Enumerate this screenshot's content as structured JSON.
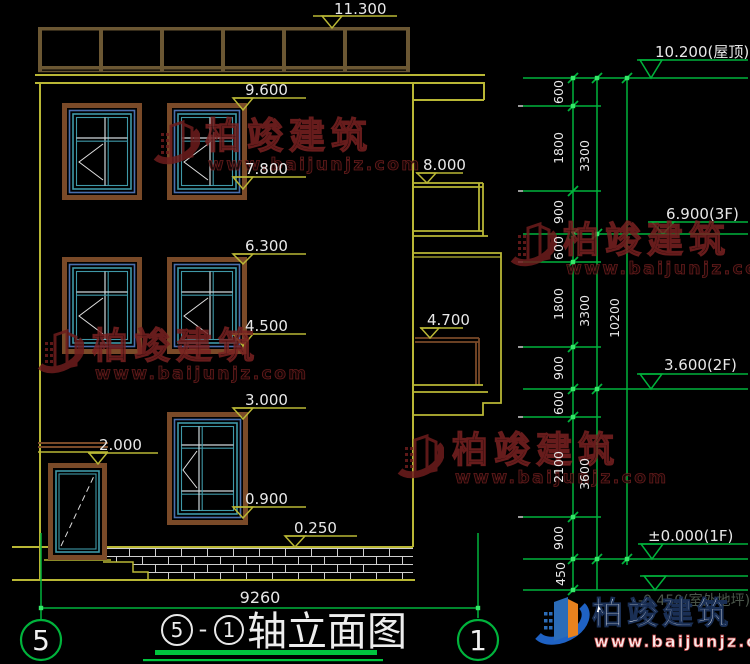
{
  "marks_left": [
    "11.300",
    "9.600",
    "7.800",
    "8.000",
    "6.300",
    "4.500",
    "4.700",
    "3.000",
    "2.000",
    "0.900",
    "0.250"
  ],
  "marks_right": [
    "10.200(屋顶)",
    "6.900(3F)",
    "3.600(2F)",
    "±0.000(1F)",
    "-0.450(室外地坪)"
  ],
  "dims": {
    "chain_inner": [
      "600",
      "1800",
      "900",
      "600",
      "1800",
      "900",
      "600",
      "2100",
      "900",
      "450"
    ],
    "chain_mid": [
      "3300",
      "3300",
      "3600"
    ],
    "chain_total": [
      "10200"
    ],
    "width": "9260"
  },
  "axes": {
    "left": "5",
    "right": "1"
  },
  "title": {
    "bubble_a": "5",
    "dash": "-",
    "bubble_b": "1",
    "text": "轴立面图"
  },
  "watermark": {
    "brand": "柏竣建筑",
    "url": "www.baijunjz.com"
  },
  "footer_logo": {
    "brand": "柏竣建筑",
    "url": "www.baijunjz.com"
  },
  "colors": {
    "cad_green": "#00b33c",
    "cad_olive": "#b9b735",
    "rail_brown": "#6b5733",
    "frame_brown": "#7a4a28",
    "frame_teal": "#3f98a8",
    "frame_blue": "#4a6fae",
    "watermark_red": "#7a2222",
    "logo_blue": "#2b6cb8",
    "logo_orange": "#e8821e"
  }
}
